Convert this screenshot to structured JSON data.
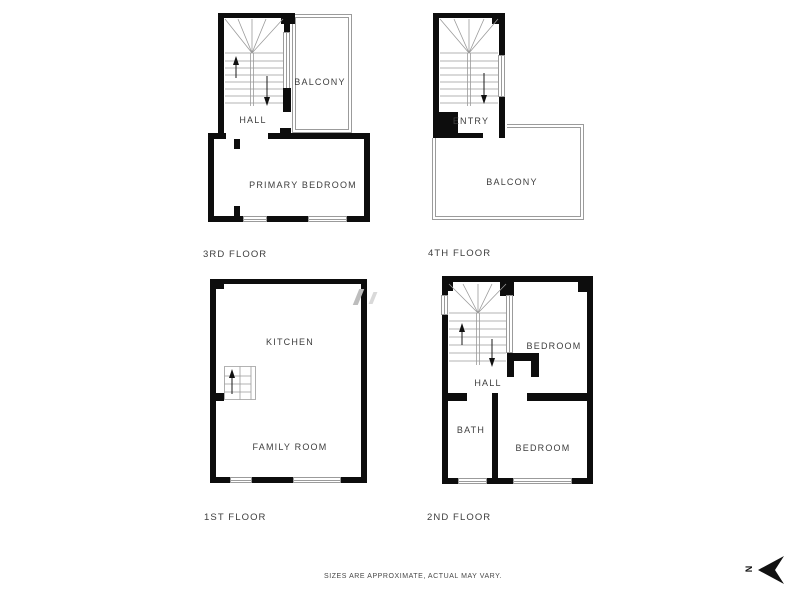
{
  "colors": {
    "wall": "#0d0d0d",
    "thin_line": "#9b9b9b",
    "label_text": "#3d3d3d",
    "background": "#ffffff"
  },
  "floor_plans": {
    "third": {
      "title": "3RD FLOOR",
      "rooms": {
        "hall": "HALL",
        "balcony": "BALCONY",
        "primary_bedroom": "PRIMARY BEDROOM"
      }
    },
    "fourth": {
      "title": "4TH FLOOR",
      "rooms": {
        "entry": "ENTRY",
        "balcony": "BALCONY"
      }
    },
    "first": {
      "title": "1ST FLOOR",
      "rooms": {
        "kitchen": "KITCHEN",
        "family_room": "FAMILY ROOM"
      }
    },
    "second": {
      "title": "2ND FLOOR",
      "rooms": {
        "hall": "HALL",
        "bedroom_top": "BEDROOM",
        "bath": "BATH",
        "bedroom_bottom": "BEDROOM"
      }
    }
  },
  "footer": {
    "disclaimer": "SIZES ARE APPROXIMATE, ACTUAL MAY VARY."
  },
  "compass": {
    "north_label": "N"
  }
}
